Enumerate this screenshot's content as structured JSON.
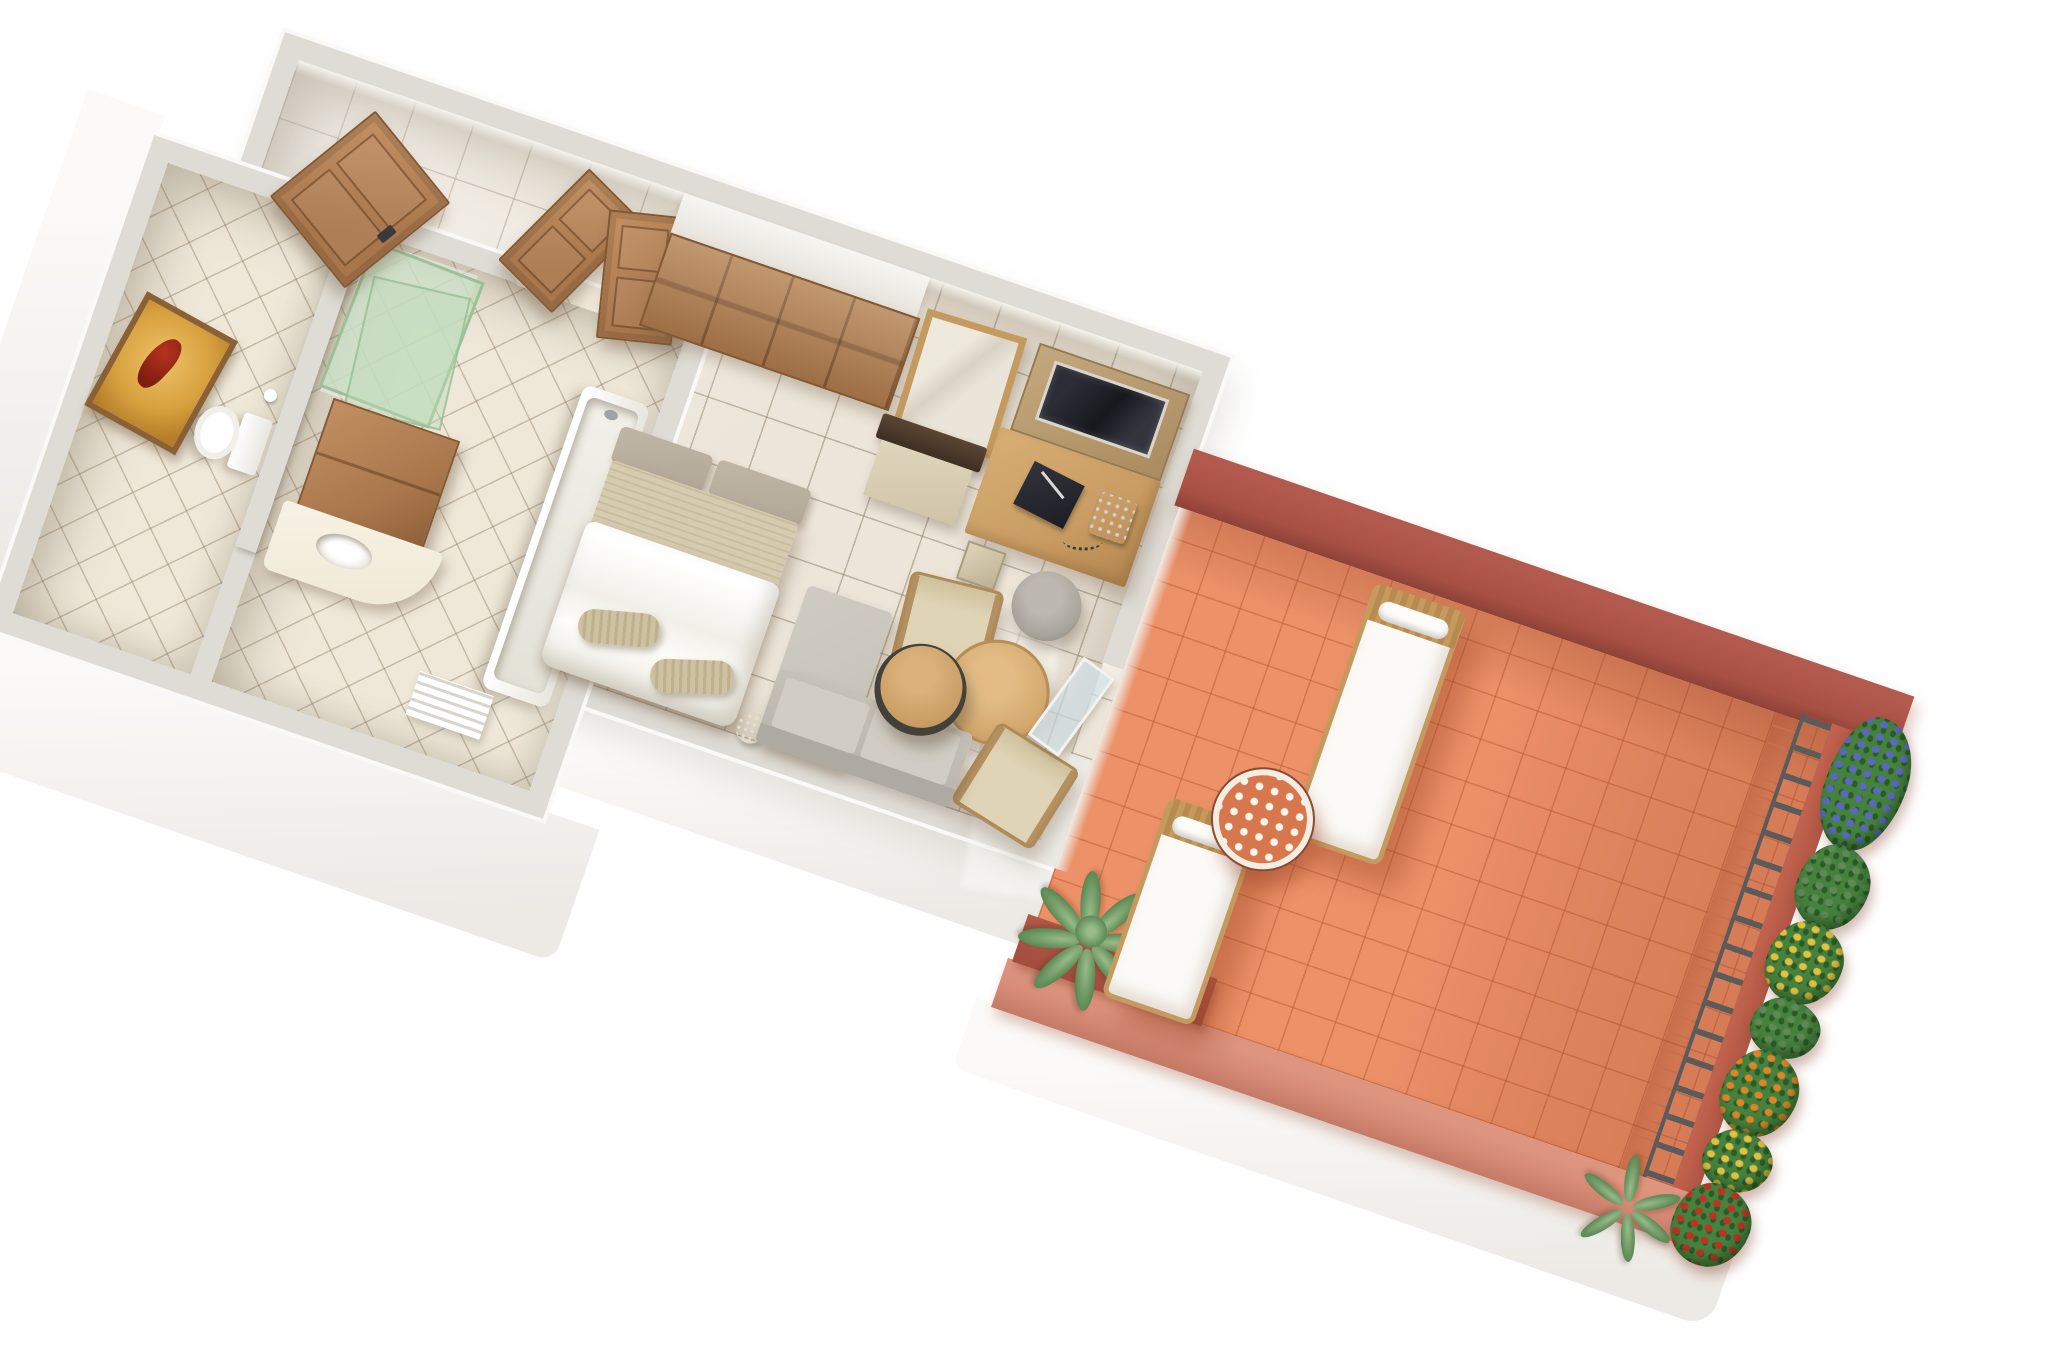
{
  "scene": {
    "title": "3D isometric floor plan of a hotel guest room with bathroom, bedroom-living area and furnished terrace",
    "background": "#ffffff",
    "view": "overhead cutaway render, plan rotated clockwise"
  },
  "palette": {
    "wall_top": "#dfdcd5",
    "wall_face": "#f7f6f3",
    "wall_inner": "#efede8",
    "floor_tile": "#ece5d8",
    "bath_tile": "#efe8d9",
    "grout": "#b3a896",
    "wood": "#a9764c",
    "wood_light": "#c08d60",
    "wood_dark": "#845832",
    "closet_wood": "#ad7c50",
    "desk_wood": "#c89c63",
    "table_wood": "#d2a76c",
    "chair_wood": "#b08b5a",
    "upholstery": "#e0d4b6",
    "linen": "#fbfaf6",
    "headboard": "#b2a897",
    "blanket": "#d5cbb0",
    "pillow": "#cdc1a1",
    "sofa": "#c6c1b8",
    "sofa_dark": "#aeaaa1",
    "tv": "#17171d",
    "stool": "#a8a39b",
    "cream": "#efe8d5",
    "glass_green": "#bcd6ba",
    "glass_blue": "#cfe0e8",
    "art_gold": "#d8a13f",
    "art_red": "#b5321f",
    "terrace_floor": "#ec9168",
    "terrace_grout": "#c96f4b",
    "terrace_wall_dark": "#a85043",
    "terrace_wall_mid": "#c2634e",
    "terrace_wall_light": "#d58a76",
    "planter_maroon": "#a34c3f",
    "railing": "#5b5b5b",
    "wicker": "#c59a5e",
    "leaf": "#46813e",
    "leaf_mid": "#5d8a55",
    "leaf_light": "#98bb8a",
    "flower_blue": "#5868c4",
    "flower_yellow": "#e3c13e",
    "flower_orange": "#e08427",
    "flower_red": "#c03125"
  },
  "building": {
    "label": "Guest room block",
    "rooms": [
      {
        "id": "entry-hall",
        "label": "Entry hall",
        "items": [
          "entrance-door",
          "wardrobe-closet",
          "bathroom-double-door"
        ]
      },
      {
        "id": "wc",
        "label": "WC",
        "items": [
          "toilet",
          "wall-art",
          "paper-roll"
        ]
      },
      {
        "id": "bathroom",
        "label": "Bathroom",
        "items": [
          "shower-glass",
          "vanity-cabinet",
          "vanity-countertop",
          "sink",
          "bathtub",
          "towel-radiator"
        ]
      },
      {
        "id": "bedroom",
        "label": "Bedroom and sitting area",
        "items": [
          "double-bed",
          "headboard-cushions",
          "blanket",
          "duvet",
          "foot-pillows",
          "mirror",
          "luggage-bench",
          "tv-panel",
          "tv-screen",
          "desk",
          "telephone",
          "folder",
          "waste-bin",
          "stool",
          "pouf",
          "armchair-1",
          "armchair-2",
          "round-table",
          "sofa",
          "chaise",
          "coffee-table",
          "terrace-door"
        ]
      }
    ]
  },
  "terrace": {
    "label": "Terrace",
    "items": [
      "sun-lounger-1",
      "sun-lounger-2",
      "mosaic-table",
      "railing",
      "flower-boxes",
      "potted-plant",
      "corner-planter"
    ],
    "flower_colors": [
      "blue",
      "yellow",
      "orange",
      "red",
      "green"
    ]
  }
}
